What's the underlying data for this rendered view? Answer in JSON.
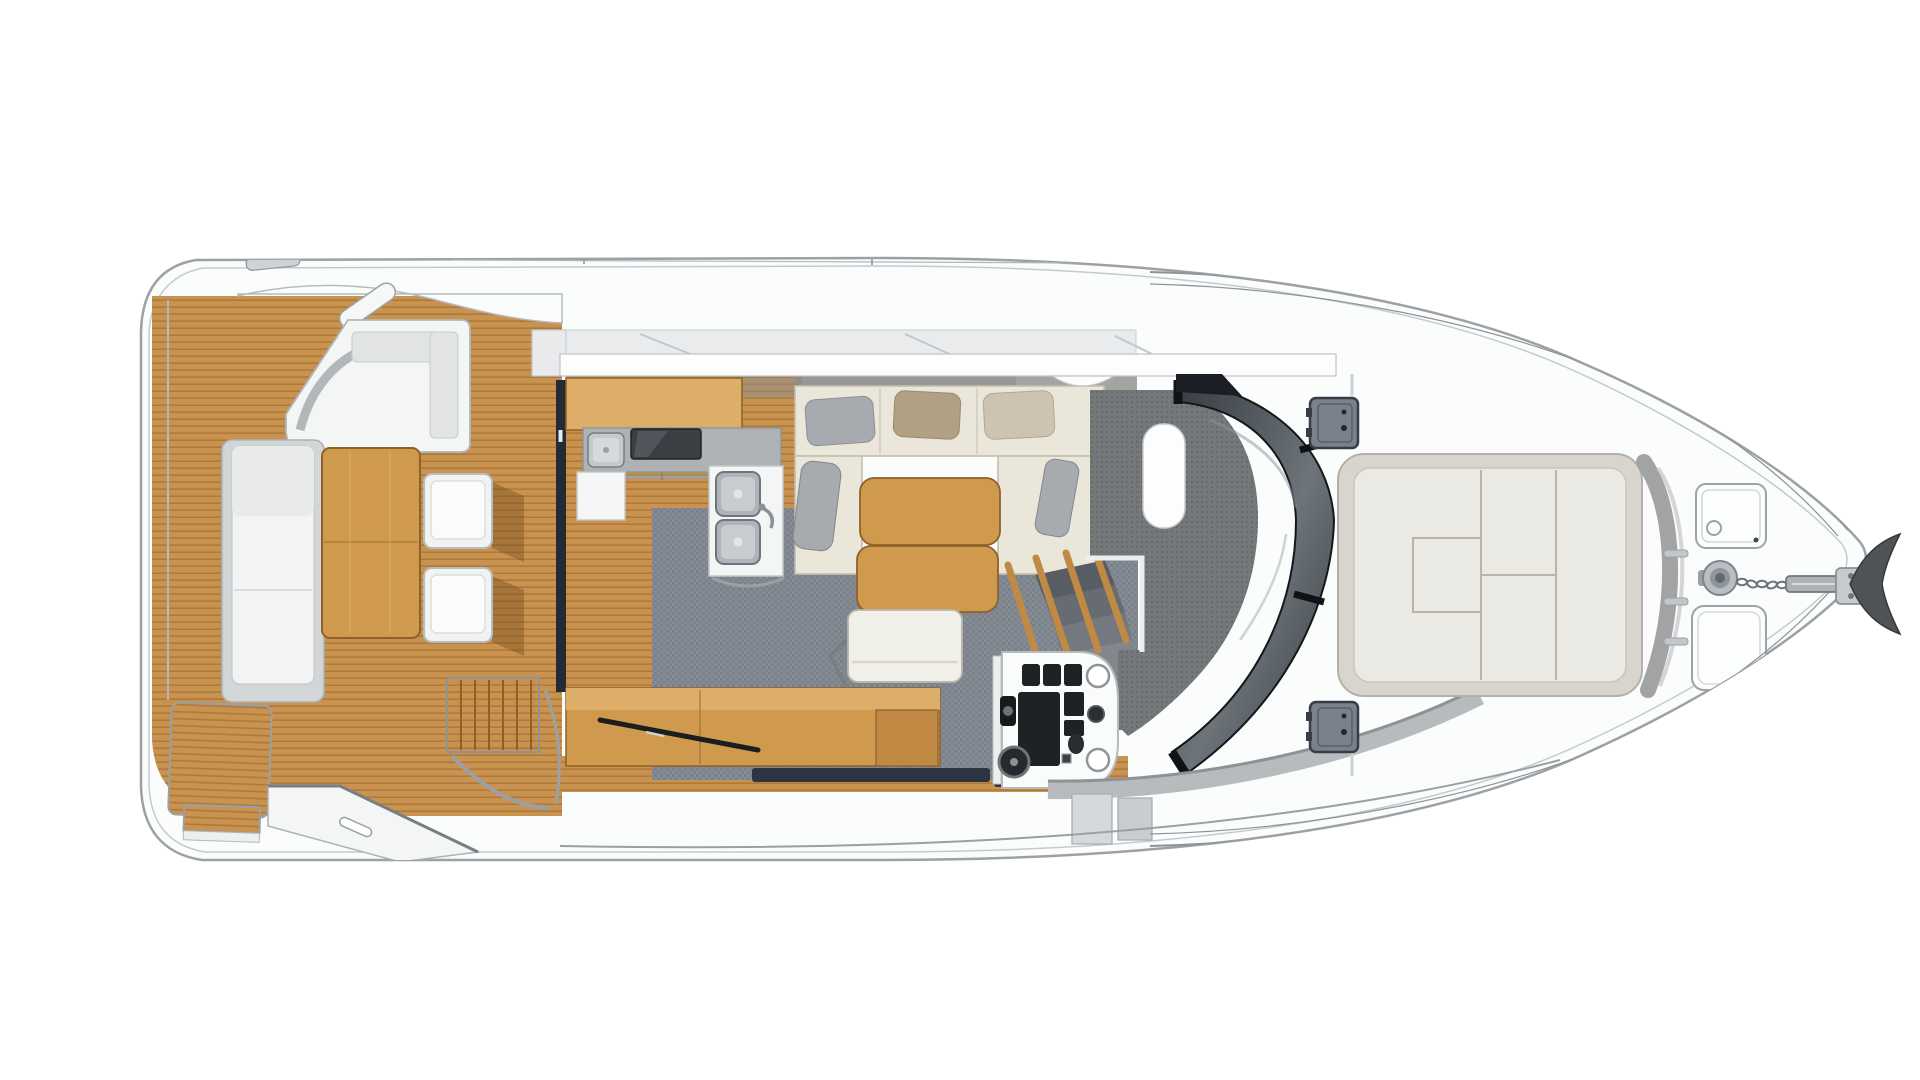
{
  "meta": {
    "title": "Motor yacht main-deck floor plan, top view, bow pointing right",
    "diagram_type": "boat-deck-plan",
    "visible_text": "none"
  },
  "palette": {
    "bg": "#ffffff",
    "hull_stroke": "#9ba1a6",
    "rubrail": "#c6cacd",
    "rail": "#8d9398",
    "chrome": "#9aa0a4",
    "deck_white": "#fbfcfc",
    "panel_grey": "#e9ebec",
    "gunwale_edge": "#b5b9bc",
    "wall_putty": "#8e8d89",
    "teak_base": "#c9924f",
    "teak_line": "#9a6a31",
    "wood": "#cf9a4e",
    "wood_dark": "#8f6128",
    "wood_top": "#dcae67",
    "carpet": "#868c95",
    "carpet_dark": "#6d737c",
    "grain": "#75787a",
    "sofa": "#eae6da",
    "sofa_edge": "#c2bdae",
    "pillow_grey": "#a7abb0",
    "pillow_tan": "#b2a085",
    "pillow_beige": "#cdc3b1",
    "white_furn": "#f2f3f2",
    "furn_edge": "#b8bcbe",
    "worktop": "#aeb2b4",
    "steel": "#c0c6ca",
    "steel_dark": "#787e83",
    "cooktop": "#3a3f43",
    "instrument": "#1f2225",
    "console": "#fafbfb",
    "glass_a": "#343a3f",
    "glass_b": "#6d747a",
    "glass_edge": "#15181b",
    "navy": "#2c3541",
    "stair1": "#585d63",
    "stair2": "#676c72",
    "stair3": "#74797f",
    "stair4": "#82878d",
    "sunpad_base": "#d7d5cd",
    "sunpad_top": "#ebe9e4",
    "sunpad_seam": "#b7b4aa",
    "wrap_grey": "#a2a3a5",
    "hatch": "#7b818c",
    "hatch_dark": "#383d45",
    "sidewalk": "#b7bbbe",
    "sidewalk_edge": "#8e9296",
    "anchor_dark": "#4e5358",
    "shadow_wood": "rgba(110,72,24,0.38)"
  },
  "regions": {
    "aft_deck": {
      "label": "Aft cockpit (teak deck)",
      "features": [
        "L-shaped bench seat",
        "sun lounger",
        "teak dining table",
        "two folding chairs",
        "stairs to flybridge",
        "swim platform",
        "angled boarding walkway"
      ]
    },
    "galley": {
      "label": "Galley",
      "features": [
        "upper wood cabinet",
        "grey worktop",
        "round-corner sink",
        "glass cooktop",
        "double stainless sink unit",
        "lower white cabinet",
        "towel rail"
      ]
    },
    "salon": {
      "label": "Salon",
      "features": [
        "U-shaped cream sofa",
        "five pillows",
        "two-leaf wood table",
        "helm bench seat",
        "wood sideboard",
        "grey carpet"
      ]
    },
    "companionway": {
      "label": "Stairs down to cabins",
      "features": [
        "wood balusters",
        "grey steps"
      ]
    },
    "helm": {
      "label": "Helm station",
      "features": [
        "instrument panels",
        "two round dials",
        "throttle",
        "steering wheel",
        "dashboard with storage slot"
      ]
    },
    "windshield": {
      "label": "Wrap-around tinted windshield",
      "features": [
        "black mullions",
        "reflection streaks"
      ]
    },
    "foredeck": {
      "label": "Foredeck",
      "features": [
        "large sun pad with seams",
        "curved grey backrest",
        "two side deck hatches",
        "two bow hatches",
        "anchor windlass",
        "anchor chain",
        "anchor",
        "bow railing"
      ]
    }
  }
}
